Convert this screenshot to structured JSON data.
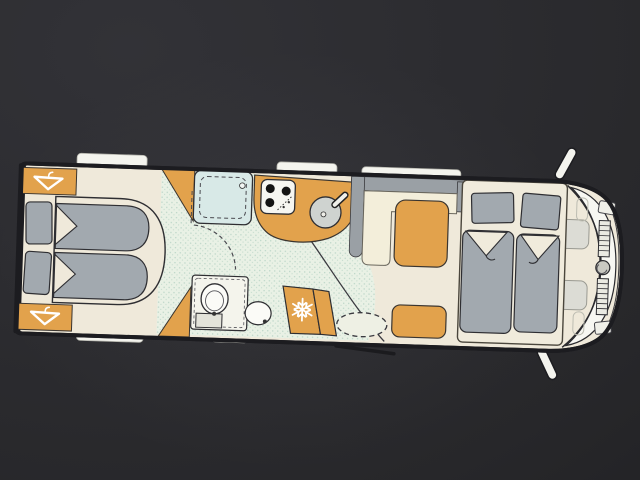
{
  "scene": {
    "kind": "motorhome-floorplan-photo",
    "orientation": "side-view-top-down, cab on right, rear bedroom on left",
    "visible_text": []
  },
  "colors": {
    "background": "#28282b",
    "outline": "#1c1c20",
    "floor": "#efe9da",
    "floor_speckle": "#e9f1e5",
    "speckle_dot": "#b9d4c6",
    "orange": "#e2a24c",
    "mattress": "#a2a9af",
    "shower_blue": "#d8e9e7",
    "counter_gray": "#9aa0a5",
    "white": "#f4f4ee",
    "cab_dark": "#6f747a"
  },
  "icons": {
    "wardrobe": "hanger-icon",
    "refrigerator": "snowflake-icon",
    "snowflake_char": "❄"
  },
  "inventory": [
    "rear-wardrobe-top",
    "rear-wardrobe-bottom",
    "rear-twin-bed-top",
    "rear-twin-bed-bottom",
    "shower-cubicle",
    "toilet",
    "washbasin",
    "kitchen-counter",
    "stove",
    "kitchen-sink",
    "refrigerator",
    "dinette-gray-surround",
    "dinette-sofa-seat",
    "side-bench",
    "entry-step",
    "entry-door",
    "drop-down-double-bed",
    "cab-front",
    "side-mirror-top",
    "side-mirror-bottom",
    "window-tabs"
  ]
}
